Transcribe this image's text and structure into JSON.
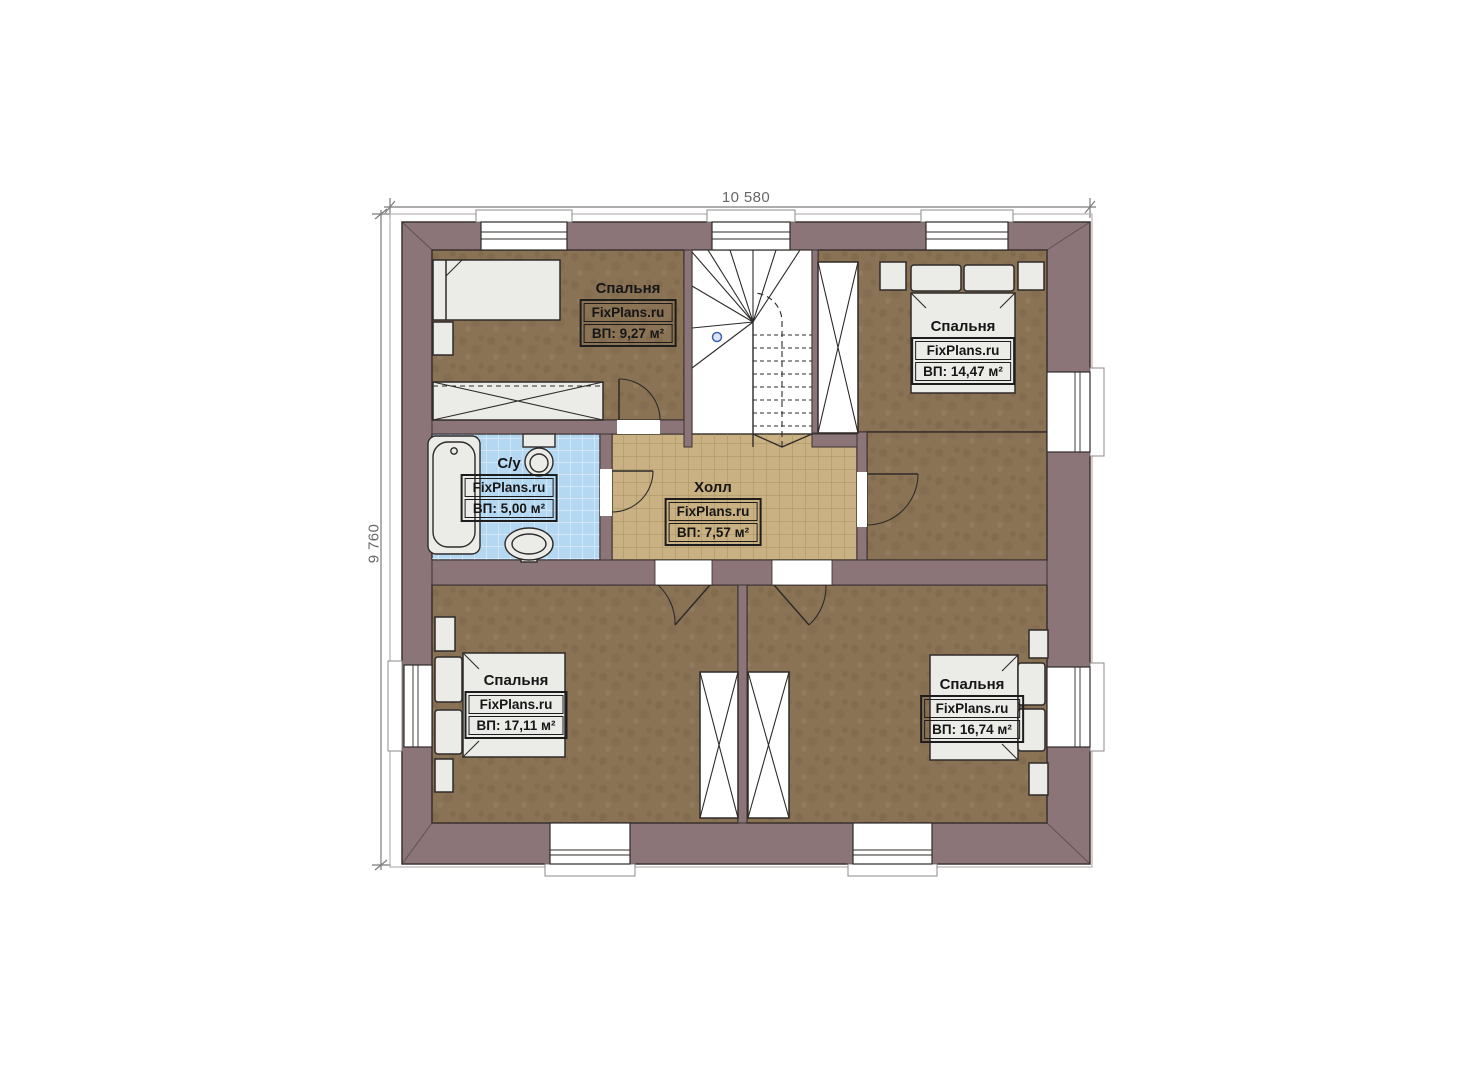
{
  "plan": {
    "dimensions": {
      "width_label": "10 580",
      "height_label": "9 760"
    },
    "rooms": [
      {
        "id": "bedroom-top-left",
        "name": "Спальня",
        "watermark": "FixPlans.ru",
        "area": "ВП: 9,27 м²"
      },
      {
        "id": "bedroom-top-right",
        "name": "Спальня",
        "watermark": "FixPlans.ru",
        "area": "ВП: 14,47 м²"
      },
      {
        "id": "bathroom",
        "name": "С/у",
        "watermark": "FixPlans.ru",
        "area": "ВП: 5,00 м²"
      },
      {
        "id": "hall",
        "name": "Холл",
        "watermark": "FixPlans.ru",
        "area": "ВП: 7,57 м²"
      },
      {
        "id": "bedroom-bottom-left",
        "name": "Спальня",
        "watermark": "FixPlans.ru",
        "area": "ВП: 17,11 м²"
      },
      {
        "id": "bedroom-bottom-right",
        "name": "Спальня",
        "watermark": "FixPlans.ru",
        "area": "ВП: 16,74 м²"
      }
    ],
    "colors": {
      "wall": "#8c7578",
      "carpet": "#8a7355",
      "hall_tile": "#c9b183",
      "bath_tile": "#b4d7f2",
      "furniture": "#ebebe8",
      "line": "#2e2b29",
      "stair_marker": "#3c62b0"
    }
  }
}
